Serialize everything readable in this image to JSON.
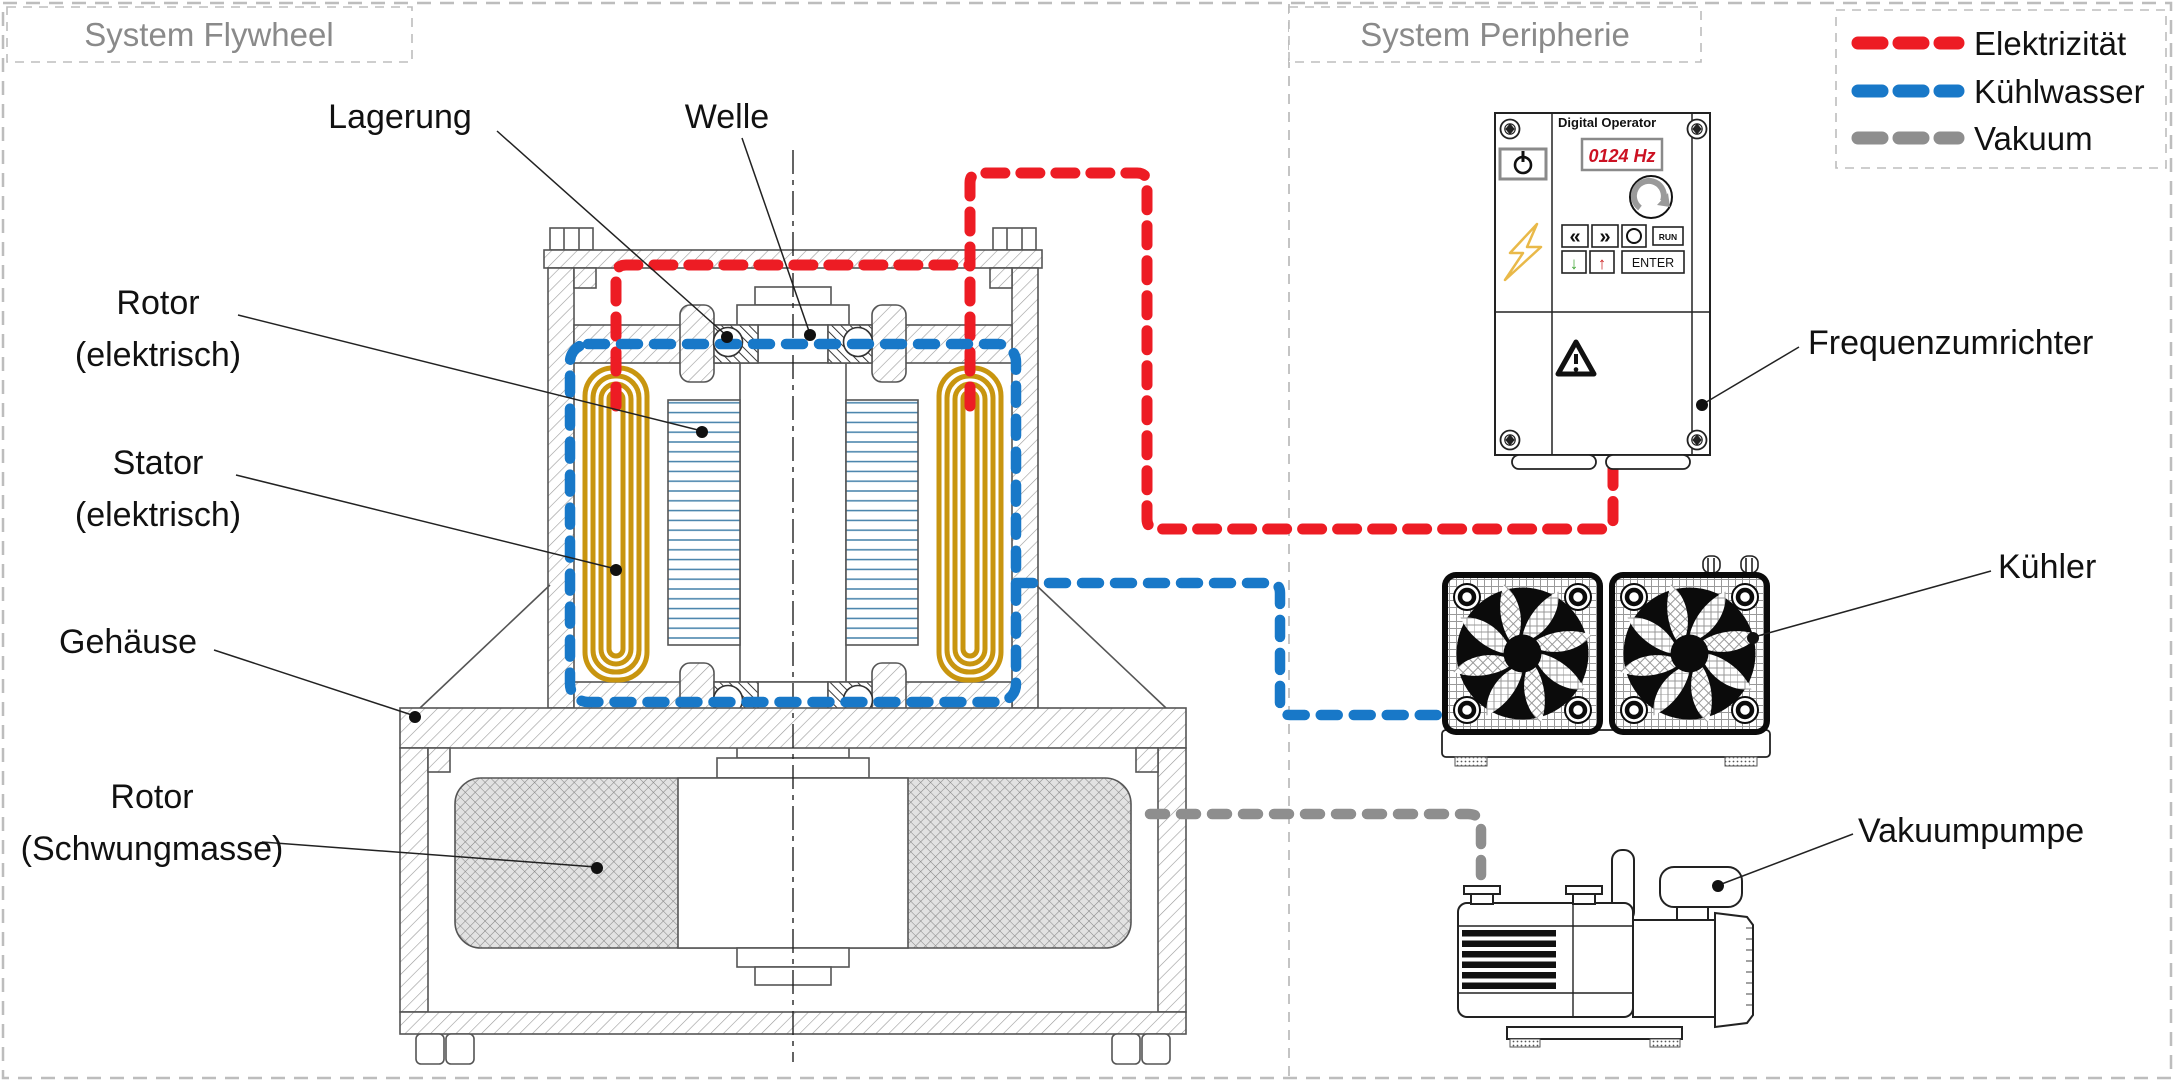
{
  "titles": {
    "system_flywheel": "System Flywheel",
    "system_peripherie": "System Peripherie"
  },
  "legend": {
    "items": [
      {
        "label": "Elektrizität",
        "color": "#ED1C24"
      },
      {
        "label": "Kühlwasser",
        "color": "#1878C8"
      },
      {
        "label": "Vakuum",
        "color": "#8E8E8E"
      }
    ]
  },
  "flywheel": {
    "labels": {
      "lagerung": "Lagerung",
      "welle": "Welle",
      "rotor_elektrisch_line1": "Rotor",
      "rotor_elektrisch_line2": "(elektrisch)",
      "stator_line1": "Stator",
      "stator_line2": "(elektrisch)",
      "gehaeuse": "Gehäuse",
      "rotor_schwungmasse_line1": "Rotor",
      "rotor_schwungmasse_line2": "(Schwungmasse)"
    },
    "colors": {
      "coil": "#C8950F",
      "lamination": "#4380A9"
    }
  },
  "peripherie": {
    "labels": {
      "frequenzumrichter": "Frequenzumrichter",
      "kuehler": "Kühler",
      "vakuumpumpe": "Vakuumpumpe"
    },
    "inverter": {
      "header": "Digital Operator",
      "display_value": "0124 Hz",
      "buttons": {
        "back": "«",
        "forward": "»",
        "run": "RUN",
        "enter": "ENTER",
        "down": "↓",
        "up": "↑"
      }
    }
  }
}
